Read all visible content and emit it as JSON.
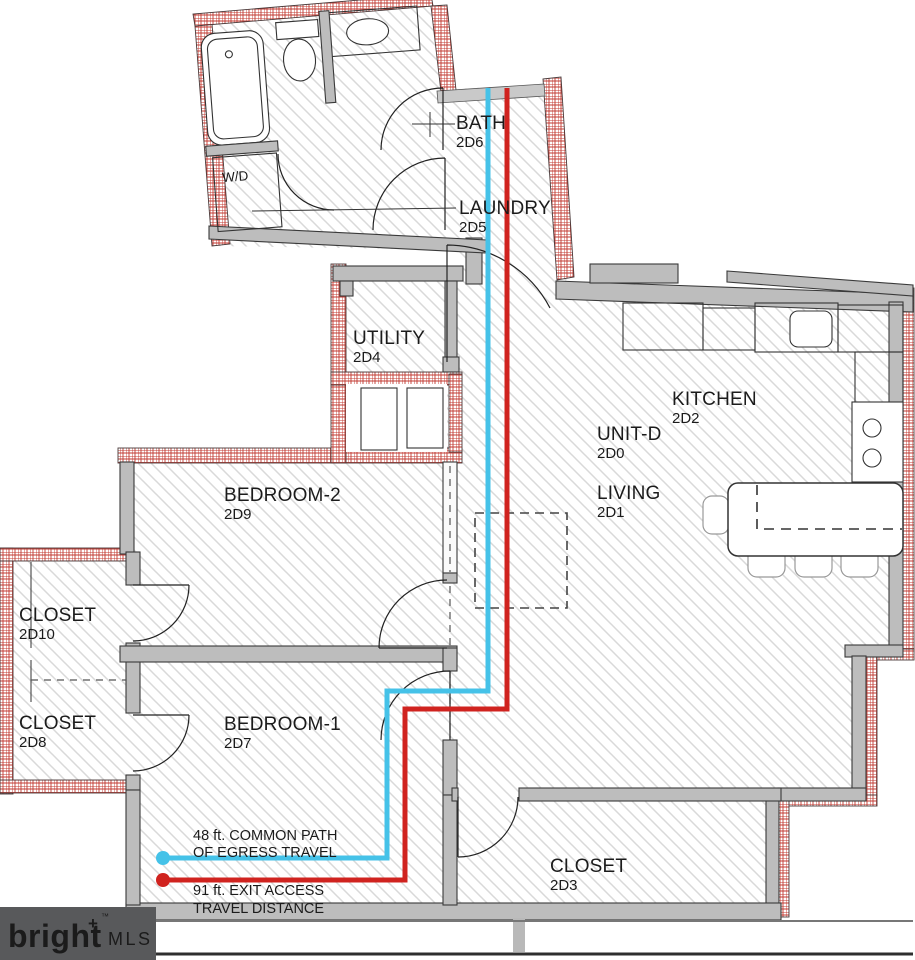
{
  "plan": {
    "rooms": [
      {
        "id": "bath",
        "name": "BATH",
        "code": "2D6"
      },
      {
        "id": "laundry",
        "name": "LAUNDRY",
        "code": "2D5"
      },
      {
        "id": "utility",
        "name": "UTILITY",
        "code": "2D4"
      },
      {
        "id": "kitchen",
        "name": "KITCHEN",
        "code": "2D2"
      },
      {
        "id": "unit",
        "name": "UNIT-D",
        "code": "2D0"
      },
      {
        "id": "living",
        "name": "LIVING",
        "code": "2D1"
      },
      {
        "id": "bedroom2",
        "name": "BEDROOM-2",
        "code": "2D9"
      },
      {
        "id": "closet10",
        "name": "CLOSET",
        "code": "2D10"
      },
      {
        "id": "closet8",
        "name": "CLOSET",
        "code": "2D8"
      },
      {
        "id": "bedroom1",
        "name": "BEDROOM-1",
        "code": "2D7"
      },
      {
        "id": "closet3",
        "name": "CLOSET",
        "code": "2D3"
      }
    ],
    "fixtures": {
      "washer_dryer": "W/D"
    },
    "egress": {
      "common_path": {
        "line1": "48 ft.  COMMON PATH",
        "line2": "OF EGRESS TRAVEL",
        "color": "#45c2e8"
      },
      "exit_access": {
        "line1": "91 ft. EXIT ACCESS",
        "line2": "TRAVEL DISTANCE",
        "color": "#d0231f"
      }
    }
  },
  "colors": {
    "wall_gray": "#bdbdbd",
    "fire_hatch_red": "#c23a32",
    "floor_hatch_gray": "#d9d9d9"
  },
  "branding": {
    "name": "bright",
    "plus": "+",
    "tm": "™",
    "suffix": "MLS",
    "box_color": "#58595b",
    "name_color": "#f4f3f1",
    "plus_color": "#e8532a",
    "mls_color": "#a7a9ac"
  }
}
